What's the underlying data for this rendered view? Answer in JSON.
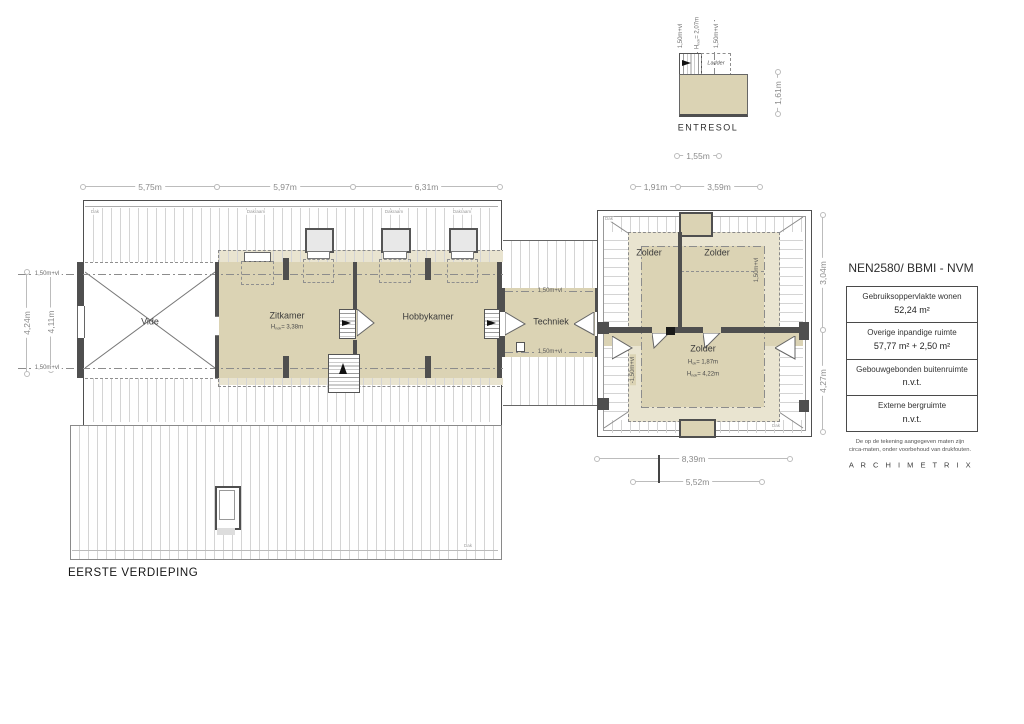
{
  "plan_title": "EERSTE VERDIEPING",
  "entresol": {
    "title": "ENTRESOL",
    "ladder": "Ladder",
    "ann_left": "1,50m+vl",
    "ann_mid_pre": "H",
    "ann_mid_sub": "nok",
    "ann_mid_val": "= 2,07m",
    "ann_right": "1,50m+vl",
    "dim_width": "1,55m",
    "dim_height": "1,61m"
  },
  "rooms": {
    "vide": "Vide",
    "zitkamer": "Zitkamer",
    "zitkamer_h_pre": "H",
    "zitkamer_h_sub": "nok",
    "zitkamer_h_val": "= 3,38m",
    "hobbykamer": "Hobbykamer",
    "techniek": "Techniek",
    "zolder_tl": "Zolder",
    "zolder_tr": "Zolder",
    "zolder_main": "Zolder",
    "zolder_h1_pre": "H",
    "zolder_h1_sub": "ok",
    "zolder_h1_val": "= 1,87m",
    "zolder_h2_pre": "H",
    "zolder_h2_sub": "nok",
    "zolder_h2_val": "= 4,22m"
  },
  "vl_labels": {
    "left_top": "1,50m+vl",
    "left_bottom": "1,50m+vl",
    "tech_top": "1,50m+vl",
    "tech_bottom": "1,50m+vl",
    "zb_right": "1,50m+vl",
    "zb_left": "-1,50m+vl"
  },
  "dims": {
    "top": [
      "5,75m",
      "5,97m",
      "6,31m"
    ],
    "top_right": [
      "1,91m",
      "3,59m"
    ],
    "left_outer": "4,24m",
    "left_inner": "4,11m",
    "right_upper": "3,04m",
    "right_lower": "4,27m",
    "bottom_outer": "8,39m",
    "bottom_inner": "5,52m"
  },
  "annotations": {
    "dak_main": "Dak",
    "dak_lower": "Dak",
    "dak_zb_tl": "Dak",
    "dak_zb_br": "Dak",
    "dakraam": [
      "Dakraam",
      "Dakraam",
      "Dakraam"
    ]
  },
  "legend": {
    "title": "NEN2580/ BBMI - NVM",
    "rows": [
      {
        "label": "Gebruiksoppervlakte wonen",
        "value": "52,24 m²"
      },
      {
        "label": "Overige inpandige ruimte",
        "value": "57,77 m² + 2,50 m²"
      },
      {
        "label": "Gebouwgebonden buitenruimte",
        "value": "n.v.t."
      },
      {
        "label": "Externe bergruimte",
        "value": "n.v.t."
      }
    ],
    "note_line1": "De op de tekening aangegeven maten zijn",
    "note_line2": "circa-maten, onder voorbehoud van drukfouten.",
    "brand": "A R C H I M E T R I X"
  },
  "colors": {
    "room_fill": "#dbd3b4",
    "room_tint": "#e9e4d0",
    "wall": "#4f4f4f",
    "hatch_line": "#d4d4d4",
    "dimension": "#bcbcbc"
  }
}
